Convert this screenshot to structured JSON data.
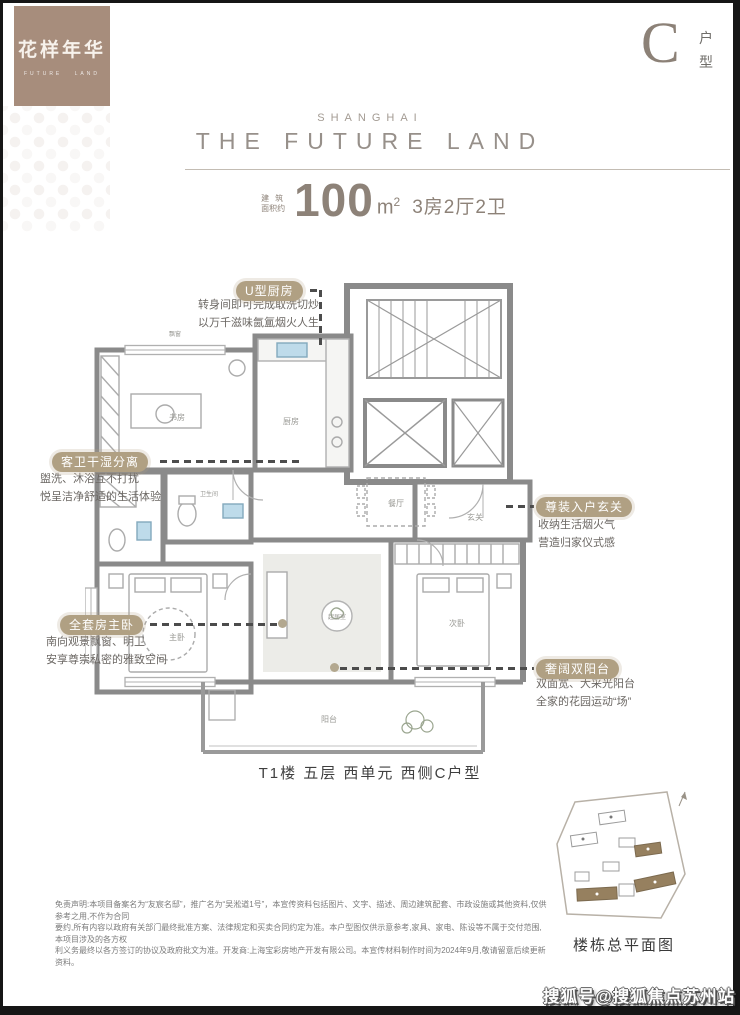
{
  "logo": {
    "title": "花样年华",
    "subtitle": "FUTURE LAND"
  },
  "unit": {
    "letter": "C",
    "label": [
      "户",
      "型"
    ]
  },
  "brand": {
    "city": "SHANGHAI",
    "name": "THE FUTURE LAND"
  },
  "area": {
    "label_line1": "建筑",
    "label_line2": "面积约",
    "value": "100",
    "unit": "m",
    "unit_sup": "2",
    "layout": "3房2厅2卫"
  },
  "callouts": [
    {
      "badge": "U型厨房",
      "lines": [
        "转身间即可完成取洗切炒",
        "以万千滋味氤氲烟火人生"
      ]
    },
    {
      "badge": "客卫干湿分离",
      "lines": [
        "盥洗、沐浴互不打扰",
        "悦呈洁净舒适的生活体验"
      ]
    },
    {
      "badge": "尊装入户玄关",
      "lines": [
        "收纳生活烟火气",
        "营造归家仪式感"
      ]
    },
    {
      "badge": "全套房主卧",
      "lines": [
        "南向观景飘窗、明卫",
        "安享尊崇私密的雅致空间"
      ]
    },
    {
      "badge": "奢阔双阳台",
      "lines": [
        "双面宽、大采光阳台",
        "全家的花园运动“场”"
      ]
    }
  ],
  "floorplan": {
    "rooms": [
      {
        "label": "书房"
      },
      {
        "label": "厨房"
      },
      {
        "label": "餐厅"
      },
      {
        "label": "玄关"
      },
      {
        "label": "卫生间"
      },
      {
        "label": "主卧"
      },
      {
        "label": "起居室"
      },
      {
        "label": "次卧"
      },
      {
        "label": "阳台"
      },
      {
        "label": "飘窗"
      }
    ]
  },
  "caption": "T1楼 五层 西单元  西侧C户型",
  "siteplan": {
    "label": "楼栋总平面图"
  },
  "disclaimer": {
    "lines": [
      "免责声明:本项目备案名为“友宸名邸”，推广名为“吴淞道1号”，本宣传资料包括图片、文字、描述、周边建筑配套、市政设施或其他资料,仅供参考之用,不作为合同",
      "要约,所有内容以政府有关部门最终批准方案、法律规定和买卖合同约定为准。本户型图仅供示意参考,家具、家电、陈设等不属于交付范围,本项目涉及的各方权",
      "利义务最终以各方签订的协议及政府批文为准。开发商:上海宝彩房地产开发有限公司。本宣传材料制作时间为2024年9月,敬请留意后续更新资料。"
    ]
  },
  "watermark": "搜狐号@搜狐焦点苏州站",
  "colors": {
    "logo_brown": "#a78d7c",
    "badge_tan": "#b0a083",
    "title_gray": "#97908a",
    "area_taupe": "#8d8278",
    "wall_gray": "#8a8a8a",
    "sink_blue": "#bedbea",
    "site_building_brown": "#96805f"
  }
}
